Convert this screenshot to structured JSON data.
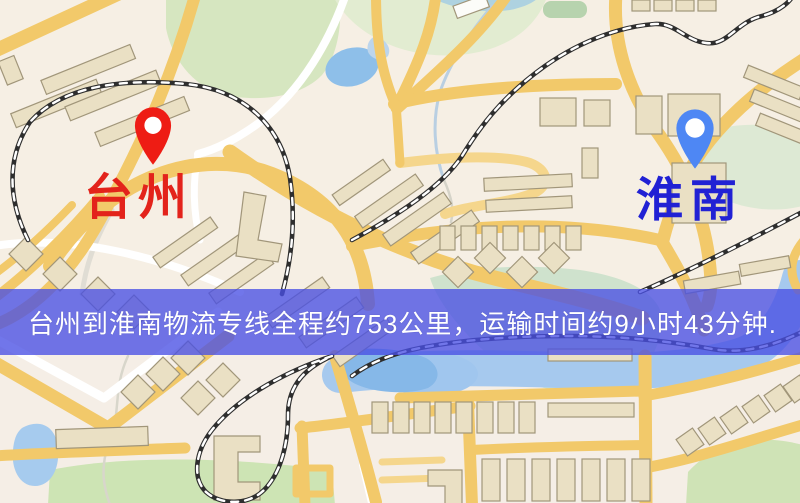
{
  "banner": {
    "text": "台州到淮南物流专线全程约753公里，运输时间约9小时43分钟.",
    "bg_color": "rgba(73,79,228,0.78)",
    "text_color": "#ffffff"
  },
  "route": {
    "origin": "台州",
    "destination": "淮南",
    "distance_text": "约753公里",
    "duration_text": "约9小时43分钟"
  },
  "markers": {
    "origin": {
      "label": "台州",
      "label_color": "#e3231b",
      "pin_color": "#ee1c14"
    },
    "destination": {
      "label": "淮南",
      "label_color": "#2121d4",
      "pin_color": "#4e87f4"
    }
  },
  "palette": {
    "map_base": "#f6efe4",
    "road_main": "#f2c96a",
    "road_minor": "#f6d98f",
    "road_white": "#ffffff",
    "park_green": "#d6e6c0",
    "water_blue": "#9dc5ec",
    "railway_dark": "#2e2e2e",
    "building_tan": "#eae0c4",
    "building_stroke": "#a1967a"
  }
}
